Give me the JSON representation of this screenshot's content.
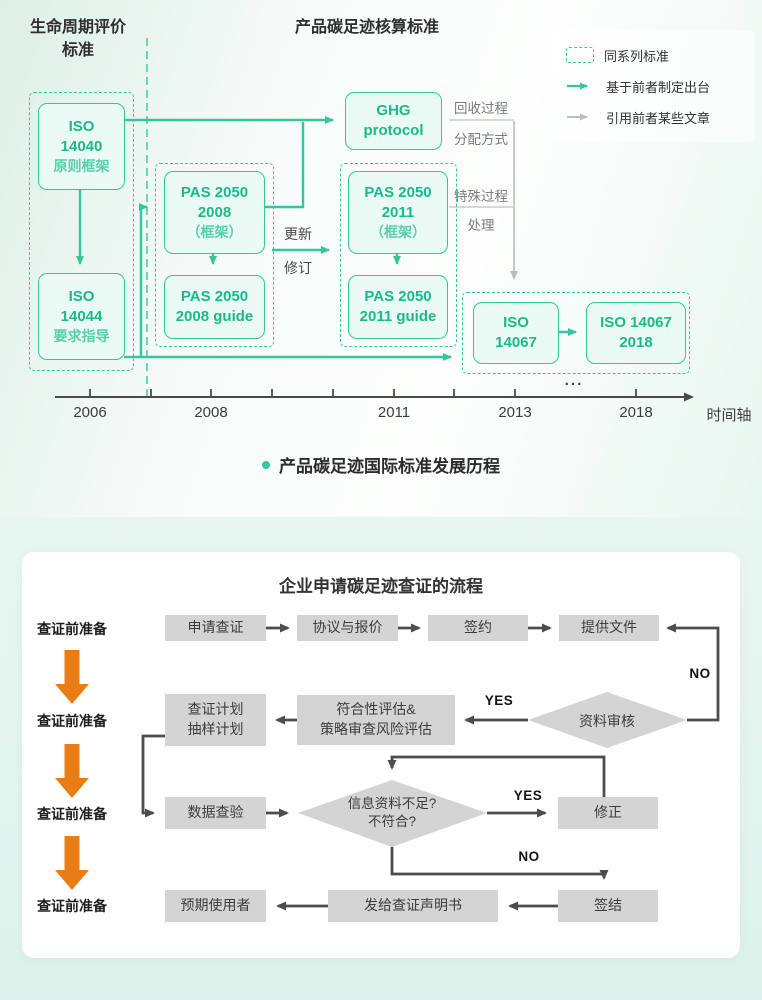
{
  "colors": {
    "green": "#35c79c",
    "green-text": "#1cb98b",
    "green-light": "#58cfab",
    "mint": "#eafaf4",
    "gray-arrow": "#bdbdbd",
    "dark": "#4d4d4d",
    "box-gray": "#d4d4d4",
    "orange": "#e87d15",
    "ink": "#2f2f2f"
  },
  "top": {
    "left_title_lines": [
      "生命周期评价",
      "标准"
    ],
    "main_title": "产品碳足迹核算标准",
    "legend": [
      {
        "label": "同系列标准"
      },
      {
        "label": "基于前者制定出台"
      },
      {
        "label": "引用前者某些文章"
      }
    ],
    "nodes": {
      "iso14040": [
        "ISO",
        "14040",
        "原则框架"
      ],
      "iso14044": [
        "ISO",
        "14044",
        "要求指导"
      ],
      "ghg": [
        "GHG",
        "protocol"
      ],
      "pas2008": [
        "PAS 2050",
        "2008",
        "（框架）"
      ],
      "pas2008_guide": [
        "PAS 2050",
        "2008 guide"
      ],
      "pas2011": [
        "PAS 2050",
        "2011",
        "（框架）"
      ],
      "pas2011_guide": [
        "PAS 2050",
        "2011 guide"
      ],
      "iso14067": [
        "ISO",
        "14067"
      ],
      "iso14067_2018": [
        "ISO 14067",
        "2018"
      ]
    },
    "edge_labels": {
      "update": "更新",
      "revise": "修订"
    },
    "process_labels": [
      "回收过程",
      "分配方式",
      "特殊过程",
      "处理"
    ],
    "timeline": {
      "years": [
        "2006",
        "2008",
        "2011",
        "2013",
        "2018"
      ],
      "ellipsis": "...",
      "axis_label": "时间轴"
    },
    "caption": "产品碳足迹国际标准发展历程"
  },
  "flow": {
    "title": "企业申请碳足迹查证的流程",
    "phases": [
      "查证前准备",
      "查证前准备",
      "查证前准备",
      "查证前准备"
    ],
    "row1": [
      "申请查证",
      "协议与报价",
      "签约",
      "提供文件"
    ],
    "plan_lines": [
      "查证计划",
      "抽样计划"
    ],
    "assess_lines": [
      "符合性评估&",
      "策略审查风险评估"
    ],
    "decision1": "资料审核",
    "decision2_lines": [
      "信息资料不足?",
      "不符合?"
    ],
    "data_check": "数据查验",
    "fix": "修正",
    "sign_off": "签结",
    "issue_statement": "发给查证声明书",
    "intended_user": "预期使用者",
    "labels": {
      "yes1": "YES",
      "no1": "NO",
      "yes2": "YES",
      "no2": "NO"
    }
  }
}
